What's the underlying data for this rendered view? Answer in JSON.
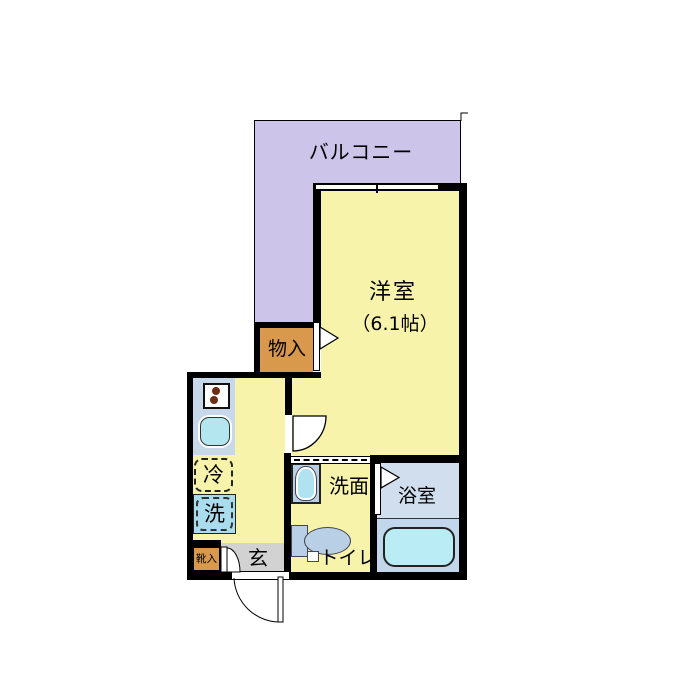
{
  "rooms": {
    "balcony": {
      "label": "バルコニー"
    },
    "western_room": {
      "label": "洋室",
      "size": "（6.1帖）"
    },
    "storage": {
      "label": "物入"
    },
    "refrigerator": {
      "label": "冷"
    },
    "washer": {
      "label": "洗"
    },
    "entrance": {
      "label": "玄"
    },
    "shoe_cabinet": {
      "label": "靴入"
    },
    "washroom": {
      "label": "洗面"
    },
    "toilet": {
      "label": "トイレ"
    },
    "bathroom": {
      "label": "浴室"
    }
  },
  "fixtures": {
    "stove": "two-burner-stove-icon",
    "kitchen_sink": "kitchen-sink-icon",
    "vanity_sink": "vanity-sink-icon",
    "toilet_bowl": "toilet-icon",
    "bathtub": "bathtub-icon",
    "window": "sliding-window-icon",
    "doors": [
      "swing-door-icon",
      "entry-swing-door-icon",
      "shoe-cabinet-door-icon",
      "closet-door-flag-icon",
      "bathroom-door-flag-icon"
    ]
  },
  "colors": {
    "wall": "#000000",
    "room_yellow": "#f7f3ab",
    "balcony_lavender": "#cdc4e9",
    "closet_orange": "#d9994d",
    "entrance_gray": "#d2d2d2",
    "counter_blue": "#c6d8e9",
    "fixture_blue": "#b9cfe5",
    "sink_cyan": "#b0e2f0",
    "washer_cyan": "#a9dcec",
    "bathroom_blue": "#d1deee",
    "bathtub_cyan": "#baecf6"
  }
}
